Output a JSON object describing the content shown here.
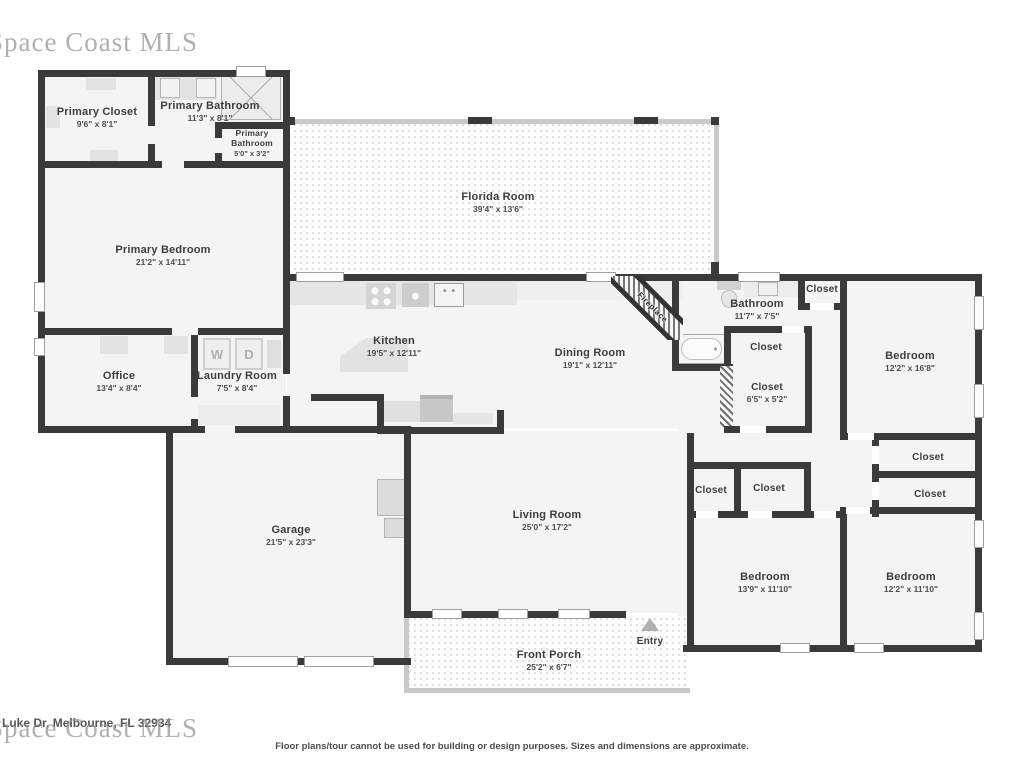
{
  "watermarks": {
    "top_left": "Space Coast MLS",
    "bottom_left": "Space Coast MLS"
  },
  "footer": {
    "address": "5 Luke Dr, Melbourne, FL 32934",
    "disclaimer": "Floor plans/tour cannot be used for building or design purposes. Sizes and dimensions are approximate."
  },
  "fixtures": {
    "washer": "W",
    "dryer": "D"
  },
  "rooms": {
    "primary_closet": {
      "name": "Primary Closet",
      "dims": "9'6\" x 8'1\""
    },
    "primary_bathroom": {
      "name": "Primary Bathroom",
      "dims": "11'3\" x 8'1\""
    },
    "primary_bathroom_small": {
      "name": "Primary Bathroom",
      "dims": "5'0\" x 3'2\""
    },
    "primary_bedroom": {
      "name": "Primary Bedroom",
      "dims": "21'2\" x 14'11\""
    },
    "office": {
      "name": "Office",
      "dims": "13'4\" x 8'4\""
    },
    "laundry_room": {
      "name": "Laundry Room",
      "dims": "7'5\" x 8'4\""
    },
    "florida_room": {
      "name": "Florida Room",
      "dims": "39'4\" x 13'6\""
    },
    "kitchen": {
      "name": "Kitchen",
      "dims": "19'5\" x 12'11\""
    },
    "dining_room": {
      "name": "Dining Room",
      "dims": "19'1\" x 12'11\""
    },
    "fireplace": {
      "name": "Fireplace"
    },
    "bathroom": {
      "name": "Bathroom",
      "dims": "11'7\" x 7'5\""
    },
    "closet_hall_top": {
      "name": "Closet"
    },
    "closet_mid": {
      "name": "Closet"
    },
    "closet_small": {
      "name": "Closet",
      "dims": "6'5\" x 5'2\""
    },
    "bedroom_right": {
      "name": "Bedroom",
      "dims": "12'2\" x 16'8\""
    },
    "closet_r1": {
      "name": "Closet"
    },
    "closet_r2": {
      "name": "Closet"
    },
    "closet_b1": {
      "name": "Closet"
    },
    "closet_b2": {
      "name": "Closet"
    },
    "bedroom_bottom_mid": {
      "name": "Bedroom",
      "dims": "13'9\" x 11'10\""
    },
    "bedroom_bottom_right": {
      "name": "Bedroom",
      "dims": "12'2\" x 11'10\""
    },
    "garage": {
      "name": "Garage",
      "dims": "21'5\" x 23'3\""
    },
    "living_room": {
      "name": "Living Room",
      "dims": "25'0\" x 17'2\""
    },
    "front_porch": {
      "name": "Front Porch",
      "dims": "25'2\" x 6'7\""
    },
    "entry": {
      "name": "Entry"
    }
  },
  "colors": {
    "wall": "#3a3a3a",
    "room_fill": "#f4f4f4",
    "fixture": "#e3e3e3",
    "window_frame": "#c9c9c9"
  }
}
